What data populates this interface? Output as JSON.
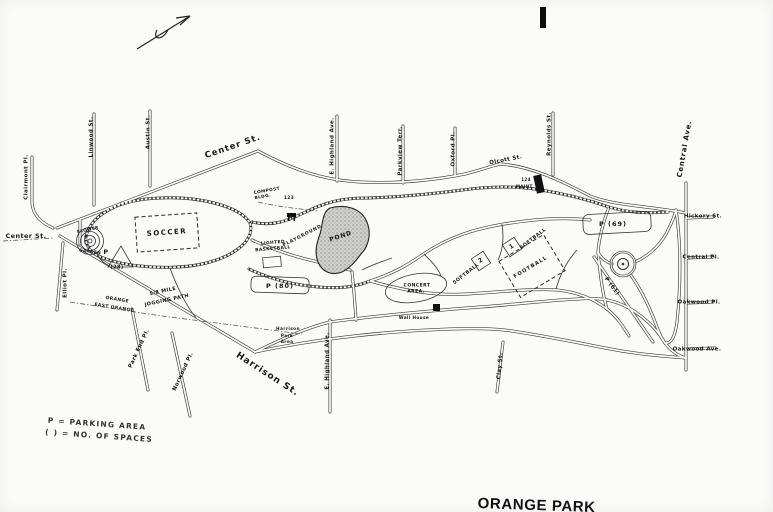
{
  "map": {
    "streets": {
      "center_st": "Center St.",
      "center_st_west": "Center St.",
      "clairmont_pl": "Clairmont Pl.",
      "linwood_st": "Linwood St.",
      "austin_st": "Austin St.",
      "e_highland_ave_north": "E. Highland Ave.",
      "parkview_terr": "Parkview Terr.",
      "oxford_pl": "Oxford Pl.",
      "olcott_st": "Olcott St.",
      "reynolds_st": "Reynolds St.",
      "central_ave": "Central Ave.",
      "hickory_st": "Hickory St.",
      "central_pl": "Central Pl.",
      "oakwood_pl": "Oakwood Pl.",
      "oakwood_ave": "Oakwood Ave.",
      "harrison_st": "Harrison St.",
      "e_highland_ave_south": "E. Highland Ave.",
      "clay_st": "Clay St.",
      "park_end_pl": "Park End Pl.",
      "norwood_pl": "Norwood Pl.",
      "elliot_pl": "Elliot Pl."
    },
    "boundary": {
      "city_north": "ORANGE",
      "city_south": "EAST ORANGE"
    },
    "features": {
      "soccer": "SOCCER",
      "flower_line1": "FLOWER",
      "flower_line2": "GARDEN",
      "pond": "POND",
      "playground": "PLAYGROUND",
      "basketball_line1": "LIGHTED",
      "basketball_line2": "BASKETBALL",
      "jogging_line1": "5/8 MILE",
      "jogging_line2": "JOGGING PATH",
      "compost_line1": "COMPOST",
      "compost_line2": "BLDG.",
      "compost_number": "123",
      "concert_line1": "CONCERT",
      "concert_line2": "AREA.",
      "softball_1_label": "SOFTBALL",
      "softball_1_number": "1",
      "softball_2_label": "SOFTBALL",
      "softball_2_number": "2",
      "football": "FOOTBALL",
      "maint_line1": "124",
      "maint_line2": "MAINT.",
      "wall_house": "Wall House",
      "harrison_park_line1": "Harrison",
      "harrison_park_line2": "Park",
      "harrison_park_line3": "Area"
    },
    "parking": {
      "p20_label": "P",
      "p20_count": "(28)",
      "p80": "P  (80)",
      "p69": "P  (69)",
      "p61": "P (61)"
    },
    "legend": {
      "line1": "P =  PARKING AREA",
      "line2": "( ) =  NO. OF SPACES"
    },
    "title_partial": "ORANGE PARK",
    "ink_color": "#2b2b2b",
    "paper_color": "#fbfbfa"
  }
}
